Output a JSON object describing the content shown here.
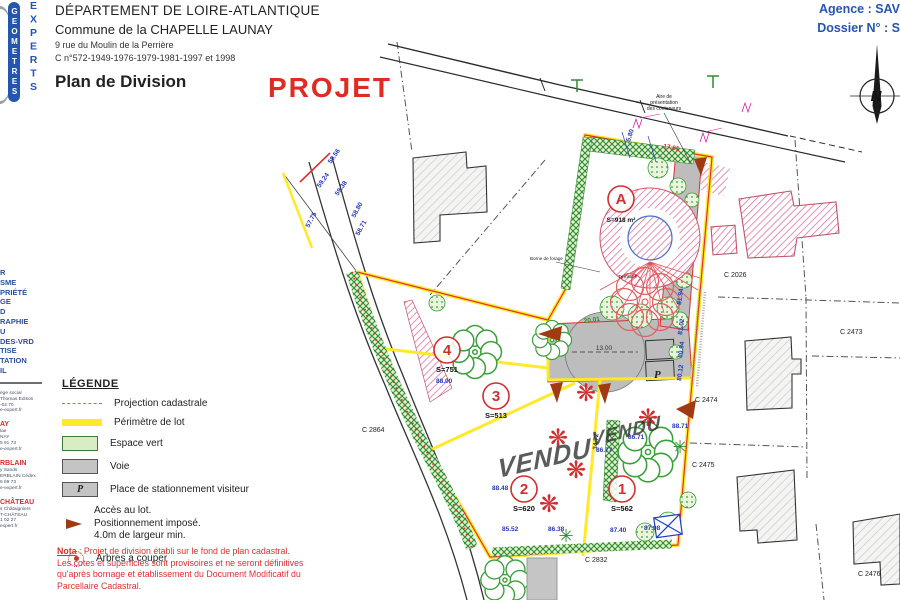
{
  "header": {
    "department": "DÉPARTEMENT DE LOIRE-ATLANTIQUE",
    "commune": "Commune de la CHAPELLE LAUNAY",
    "address": "9 rue du Moulin de la Perrière",
    "cadastre": "C n°572-1949-1976-1979-1981-1997 et 1998",
    "doc_title": "Plan de Division",
    "stamp": "PROJET",
    "agence": "Agence : SAV",
    "dossier": "Dossier N° : S"
  },
  "logo": {
    "column1": "GEOMETRES",
    "column2": "EXPERTS"
  },
  "sidebar": {
    "services": [
      "R",
      "SME",
      "PRIÉTÉ",
      "GE",
      "D",
      "RAPHIE",
      "U",
      "DES-VRD",
      "TISE",
      "TATION",
      "IL"
    ],
    "offices": [
      {
        "city": "",
        "lines": [
          "ège social",
          "Thomas Edison",
          "-02 70",
          "e-expert.fr"
        ]
      },
      {
        "city": "AY",
        "lines": [
          "lae",
          "NAY",
          "5 91 73",
          "e-expert.fr"
        ]
      },
      {
        "city": "RBLAIN",
        "lines": [
          "y Sands",
          "ERBLAIN Cédex",
          "6 59 73",
          "e-expert.fr"
        ]
      },
      {
        "city": "CHÂTEAU",
        "lines": [
          "s Châtaigniers",
          "T-CHÂTEAU",
          "1 02 27",
          "expert.fr"
        ]
      }
    ]
  },
  "legend": {
    "title": "LÉGENDE",
    "items": [
      {
        "label": "Projection cadastrale"
      },
      {
        "label": "Périmètre de lot"
      },
      {
        "label": "Espace vert"
      },
      {
        "label": "Voie"
      },
      {
        "label": "Place de stationnement visiteur"
      },
      {
        "lines": [
          "Accès au lot.",
          "Positionnement imposé.",
          "4.0m de largeur min."
        ]
      },
      {
        "label": "Arbres a couper"
      }
    ],
    "p_swatch": "P"
  },
  "nota": {
    "label": "Nota",
    "line1": " : Projet de division établi sur le fond de plan cadastral.",
    "line2": "Les cotes et superficies sont provisoires et ne seront définitives",
    "line3": "qu'après bornage et établissement du Document Modificatif du",
    "line4": "Parcellaire Cadastral."
  },
  "map": {
    "lots": [
      {
        "id": "A",
        "area": "S=918 m²"
      },
      {
        "id": "4",
        "area": "S=751"
      },
      {
        "id": "3",
        "area": "S=513"
      },
      {
        "id": "2",
        "area": "S=620"
      },
      {
        "id": "1",
        "area": "S=562"
      }
    ],
    "parcels": [
      "C 2026",
      "C 2473",
      "C 2474",
      "C 2475",
      "C 2476",
      "C 2832",
      "C 2864"
    ],
    "vendu": "VENDU",
    "terrasse": "Terrasse",
    "borne": "Borne de forage",
    "containers": [
      "Aire de",
      "présentation",
      "des conteneurs"
    ],
    "p_label": "P",
    "north": "N",
    "dims": [
      "59.56",
      "59.24",
      "59.38",
      "58.80",
      "58.71",
      "57.75",
      "85.52",
      "86.38",
      "87.40",
      "87.98",
      "81.94",
      "81.02",
      "80.94",
      "80.12",
      "88.48",
      "86.77",
      "86.71",
      "88.71",
      "88.00",
      "34.72",
      "20.01",
      "13.00",
      "17.81",
      "5.80"
    ]
  },
  "icons": {
    "tree_cut": "❋",
    "tree_branch": "✳"
  }
}
